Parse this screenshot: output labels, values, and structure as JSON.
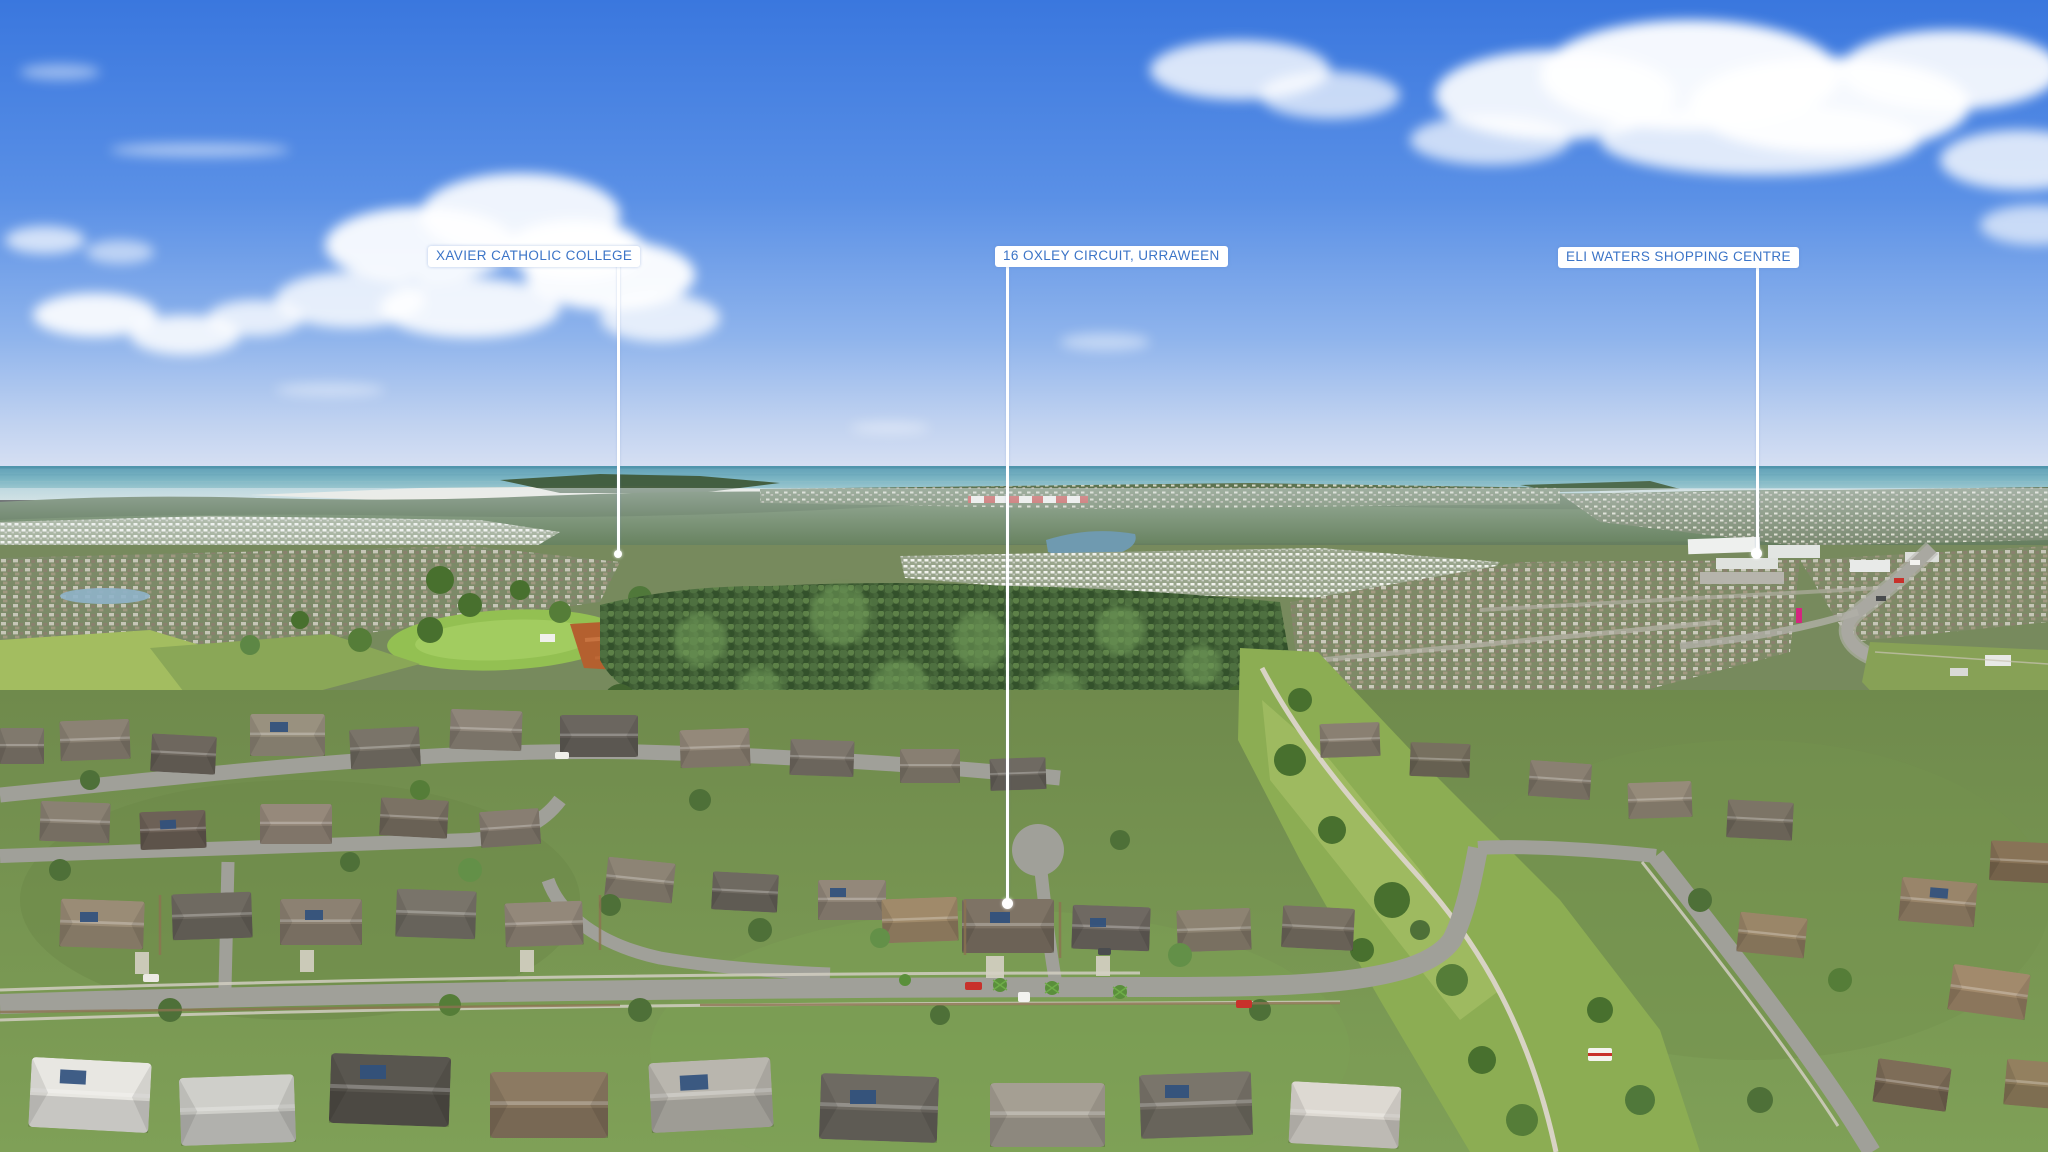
{
  "callouts": [
    {
      "id": "xavier",
      "label": "XAVIER CATHOLIC COLLEGE"
    },
    {
      "id": "oxley",
      "label": "16 OXLEY CIRCUIT, URRAWEEN"
    },
    {
      "id": "eli",
      "label": "ELI WATERS SHOPPING CENTRE"
    }
  ],
  "colors": {
    "label_text": "#3b74c7",
    "label_background": "#ffffff",
    "leader_line": "#ffffff",
    "sky_top": "#3a77de",
    "sky_horizon": "#d7e0f3",
    "ocean": "#7db6c4"
  }
}
